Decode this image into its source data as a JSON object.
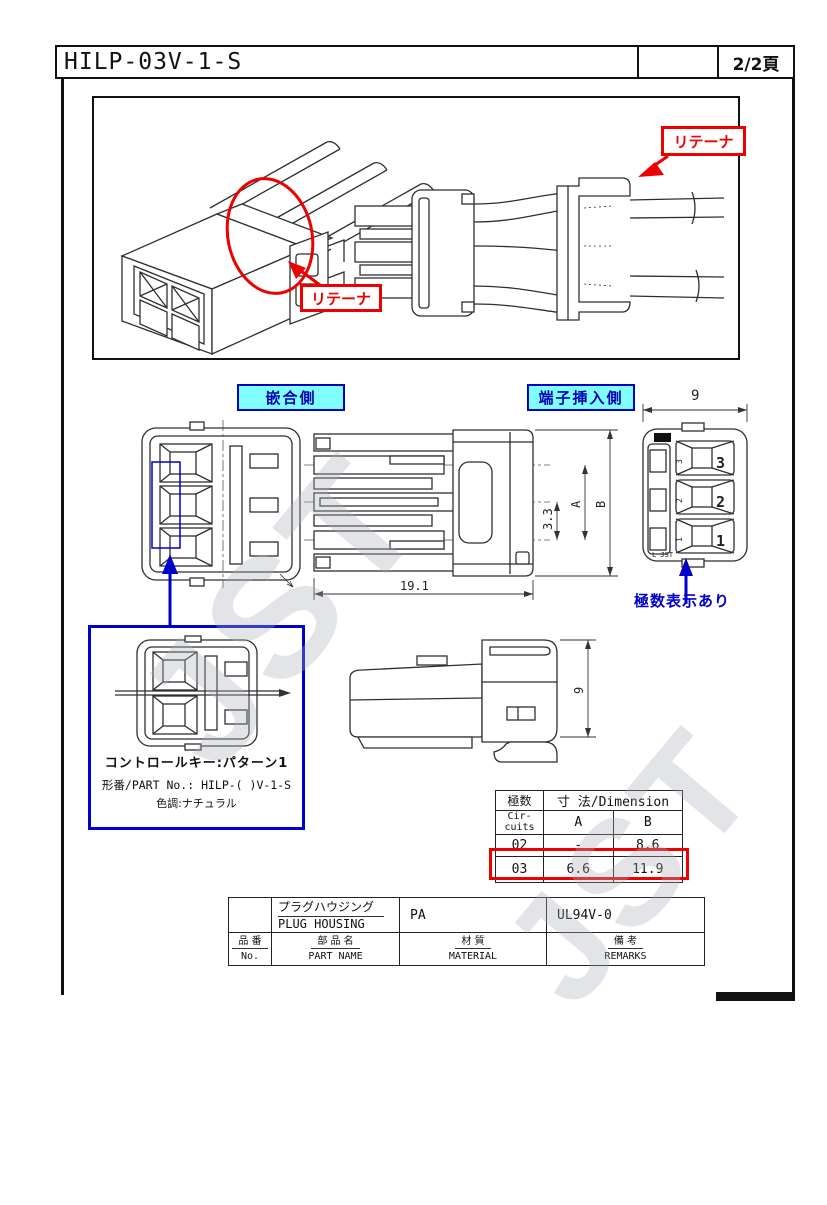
{
  "page": {
    "title": "HILP-03V-1-S",
    "page_number": "2/2頁"
  },
  "colors": {
    "red": "#ee0000",
    "blue": "#0000cc",
    "cyan_bg": "#80ffff"
  },
  "labels": {
    "retainer_iso": "リテーナ",
    "retainer_side": "リテーナ",
    "mating_side": "嵌合側",
    "terminal_insertion_side": "端子挿入側",
    "circuit_count_note": "極数表示あり"
  },
  "dimensions": {
    "rear_width": "9",
    "pitch": "3.3",
    "dim_a": "A",
    "dim_b": "B",
    "overall_length": "19.1",
    "side_height": "9"
  },
  "rear_view": {
    "circuit_numbers": [
      "3",
      "2",
      "1"
    ],
    "molded_text": "L JST"
  },
  "detail_box": {
    "control_key": "コントロールキー:パターン1",
    "part_no": "形番/PART No.: HILP-( )V-1-S",
    "color_tone": "色調:ナチュラル"
  },
  "dim_table": {
    "header_circuits_jp": "極数",
    "header_circuits_en1": "Cir-",
    "header_circuits_en2": "cuits",
    "header_dimension": "寸 法/Dimension",
    "col_a": "A",
    "col_b": "B",
    "rows": [
      {
        "circuits": "02",
        "a": "-",
        "b": "8.6"
      },
      {
        "circuits": "03",
        "a": "6.6",
        "b": "11.9"
      }
    ]
  },
  "parts_table": {
    "part_name_jp": "プラグハウジング",
    "part_name_en": "PLUG HOUSING",
    "material": "PA",
    "remarks": "UL94V-0",
    "col_no_jp": "品 番",
    "col_no_en": "No.",
    "col_name_jp": "部 品 名",
    "col_name_en": "PART NAME",
    "col_material_jp": "材 質",
    "col_material_en": "MATERIAL",
    "col_remarks_jp": "備 考",
    "col_remarks_en": "REMARKS"
  },
  "watermark": "JST"
}
